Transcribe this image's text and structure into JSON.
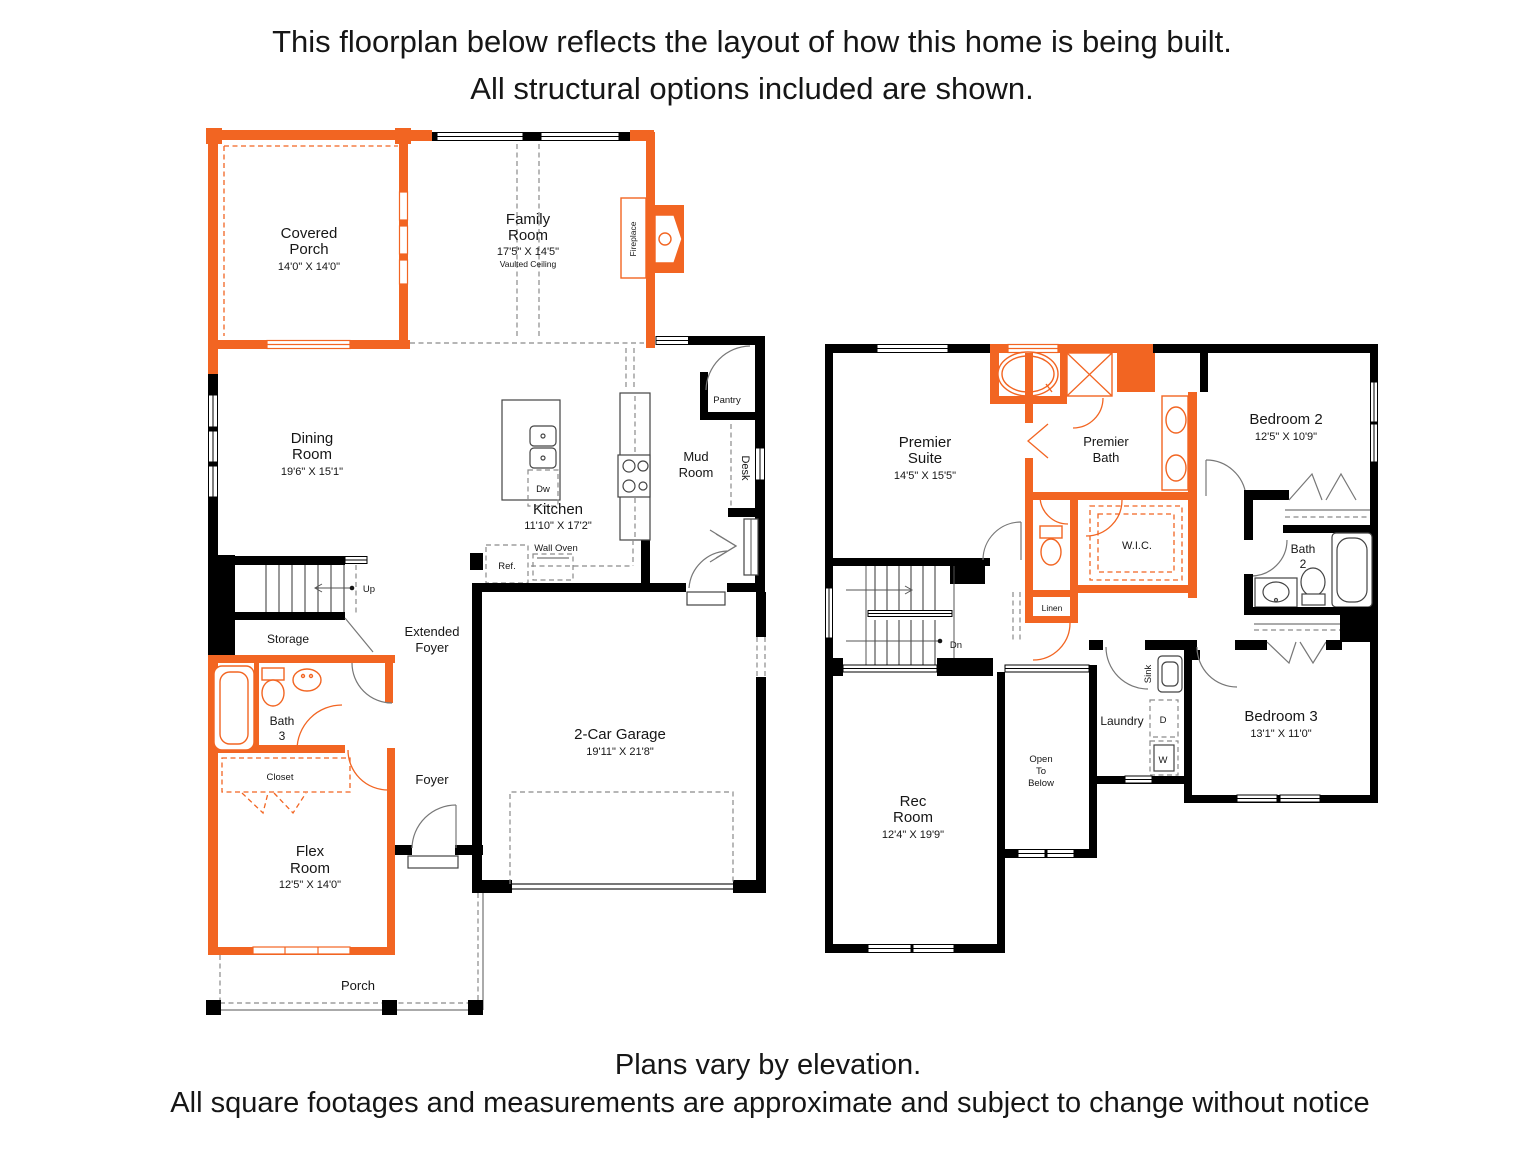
{
  "header": {
    "line1": "This floorplan below reflects the layout of how this home is being built.",
    "line2": "All structural options included are shown."
  },
  "footer": {
    "line1": "Plans vary by elevation.",
    "line2": "All square footages and measurements are approximate and subject to change without notice"
  },
  "colors": {
    "wall": "#000000",
    "structural_option": "#F26522"
  },
  "floor1": {
    "covered_porch_1": "Covered",
    "covered_porch_2": "Porch",
    "covered_porch_dims": "14'0\" X 14'0\"",
    "family_1": "Family",
    "family_2": "Room",
    "family_dims": "17'5\" X 14'5\"",
    "family_note": "Vaulted Ceiling",
    "fireplace": "Fireplace",
    "pantry": "Pantry",
    "dining_1": "Dining",
    "dining_2": "Room",
    "dining_dims": "19'6\" X 15'1\"",
    "mud_1": "Mud",
    "mud_2": "Room",
    "desk": "Desk",
    "kitchen": "Kitchen",
    "kitchen_dims": "11'10\" X 17'2\"",
    "dw": "Dw",
    "ref": "Ref.",
    "wall_oven": "Wall Oven",
    "up": "Up",
    "storage": "Storage",
    "ext_foyer_1": "Extended",
    "ext_foyer_2": "Foyer",
    "bath3_1": "Bath",
    "bath3_2": "3",
    "closet": "Closet",
    "foyer": "Foyer",
    "garage": "2-Car Garage",
    "garage_dims": "19'11\" X 21'8\"",
    "flex_1": "Flex",
    "flex_2": "Room",
    "flex_dims": "12'5\" X 14'0\"",
    "porch": "Porch"
  },
  "floor2": {
    "suite_1": "Premier",
    "suite_2": "Suite",
    "suite_dims": "14'5\" X 15'5\"",
    "bath_1": "Premier",
    "bath_2": "Bath",
    "wic": "W.I.C.",
    "linen": "Linen",
    "bed2": "Bedroom 2",
    "bed2_dims": "12'5\" X 10'9\"",
    "bath2_1": "Bath",
    "bath2_2": "2",
    "dn": "Dn",
    "sink": "Sink",
    "laundry": "Laundry",
    "dryer": "D",
    "washer": "W",
    "open_1": "Open",
    "open_2": "To",
    "open_3": "Below",
    "bed3": "Bedroom 3",
    "bed3_dims": "13'1\" X 11'0\"",
    "rec_1": "Rec",
    "rec_2": "Room",
    "rec_dims": "12'4\" X 19'9\""
  }
}
